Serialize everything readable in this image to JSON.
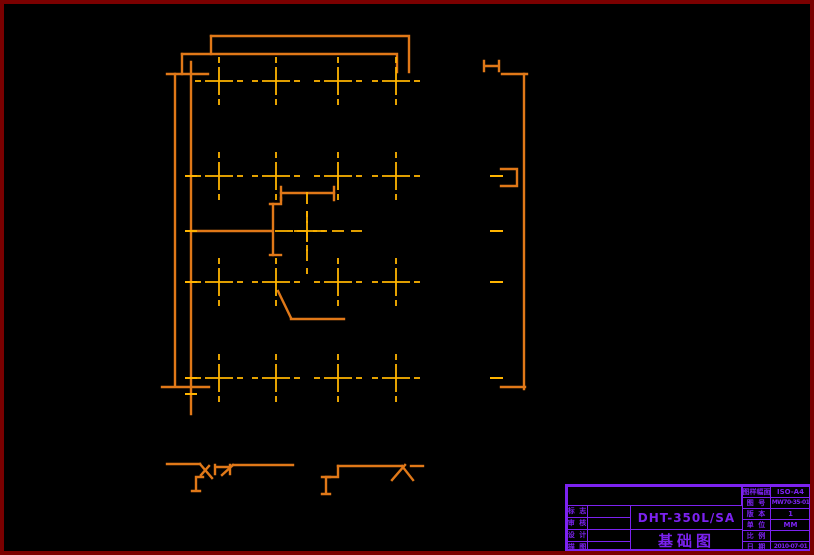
{
  "colors": {
    "background": "#000000",
    "sheet_border": "#7a0000",
    "plan_outline": "#e07818",
    "center_marks": "#ffb400",
    "title_block": "#7c22f0"
  },
  "plan": {
    "cross_cols": [
      215,
      272,
      334,
      392
    ],
    "cross_rows": [
      77,
      172,
      278,
      374
    ],
    "center_mark": {
      "x": 303,
      "y": 227
    },
    "edge_dashes": {
      "x1": 486,
      "x2": 499,
      "rows": [
        172,
        227,
        278,
        374
      ]
    },
    "left_ticks": {
      "x1": 181,
      "x2": 193,
      "rows": [
        172,
        227,
        278,
        374,
        390
      ]
    }
  },
  "title_block": {
    "model": "DHT-350L/SA",
    "drawing_title": "基础图",
    "left_rows": [
      {
        "label": "标 志"
      },
      {
        "label": "审 核"
      },
      {
        "label": "设 计"
      },
      {
        "label": "描 图"
      }
    ],
    "right_rows": [
      {
        "label": "图样幅面",
        "value": "ISO-A4"
      },
      {
        "label": "图 号",
        "value": "MW70-35-01"
      },
      {
        "label": "版 本",
        "value": "1"
      },
      {
        "label": "单 位",
        "value": "MM"
      },
      {
        "label": "比 例",
        "value": ""
      },
      {
        "label": "日 期",
        "value": "2010-07-01"
      }
    ]
  }
}
